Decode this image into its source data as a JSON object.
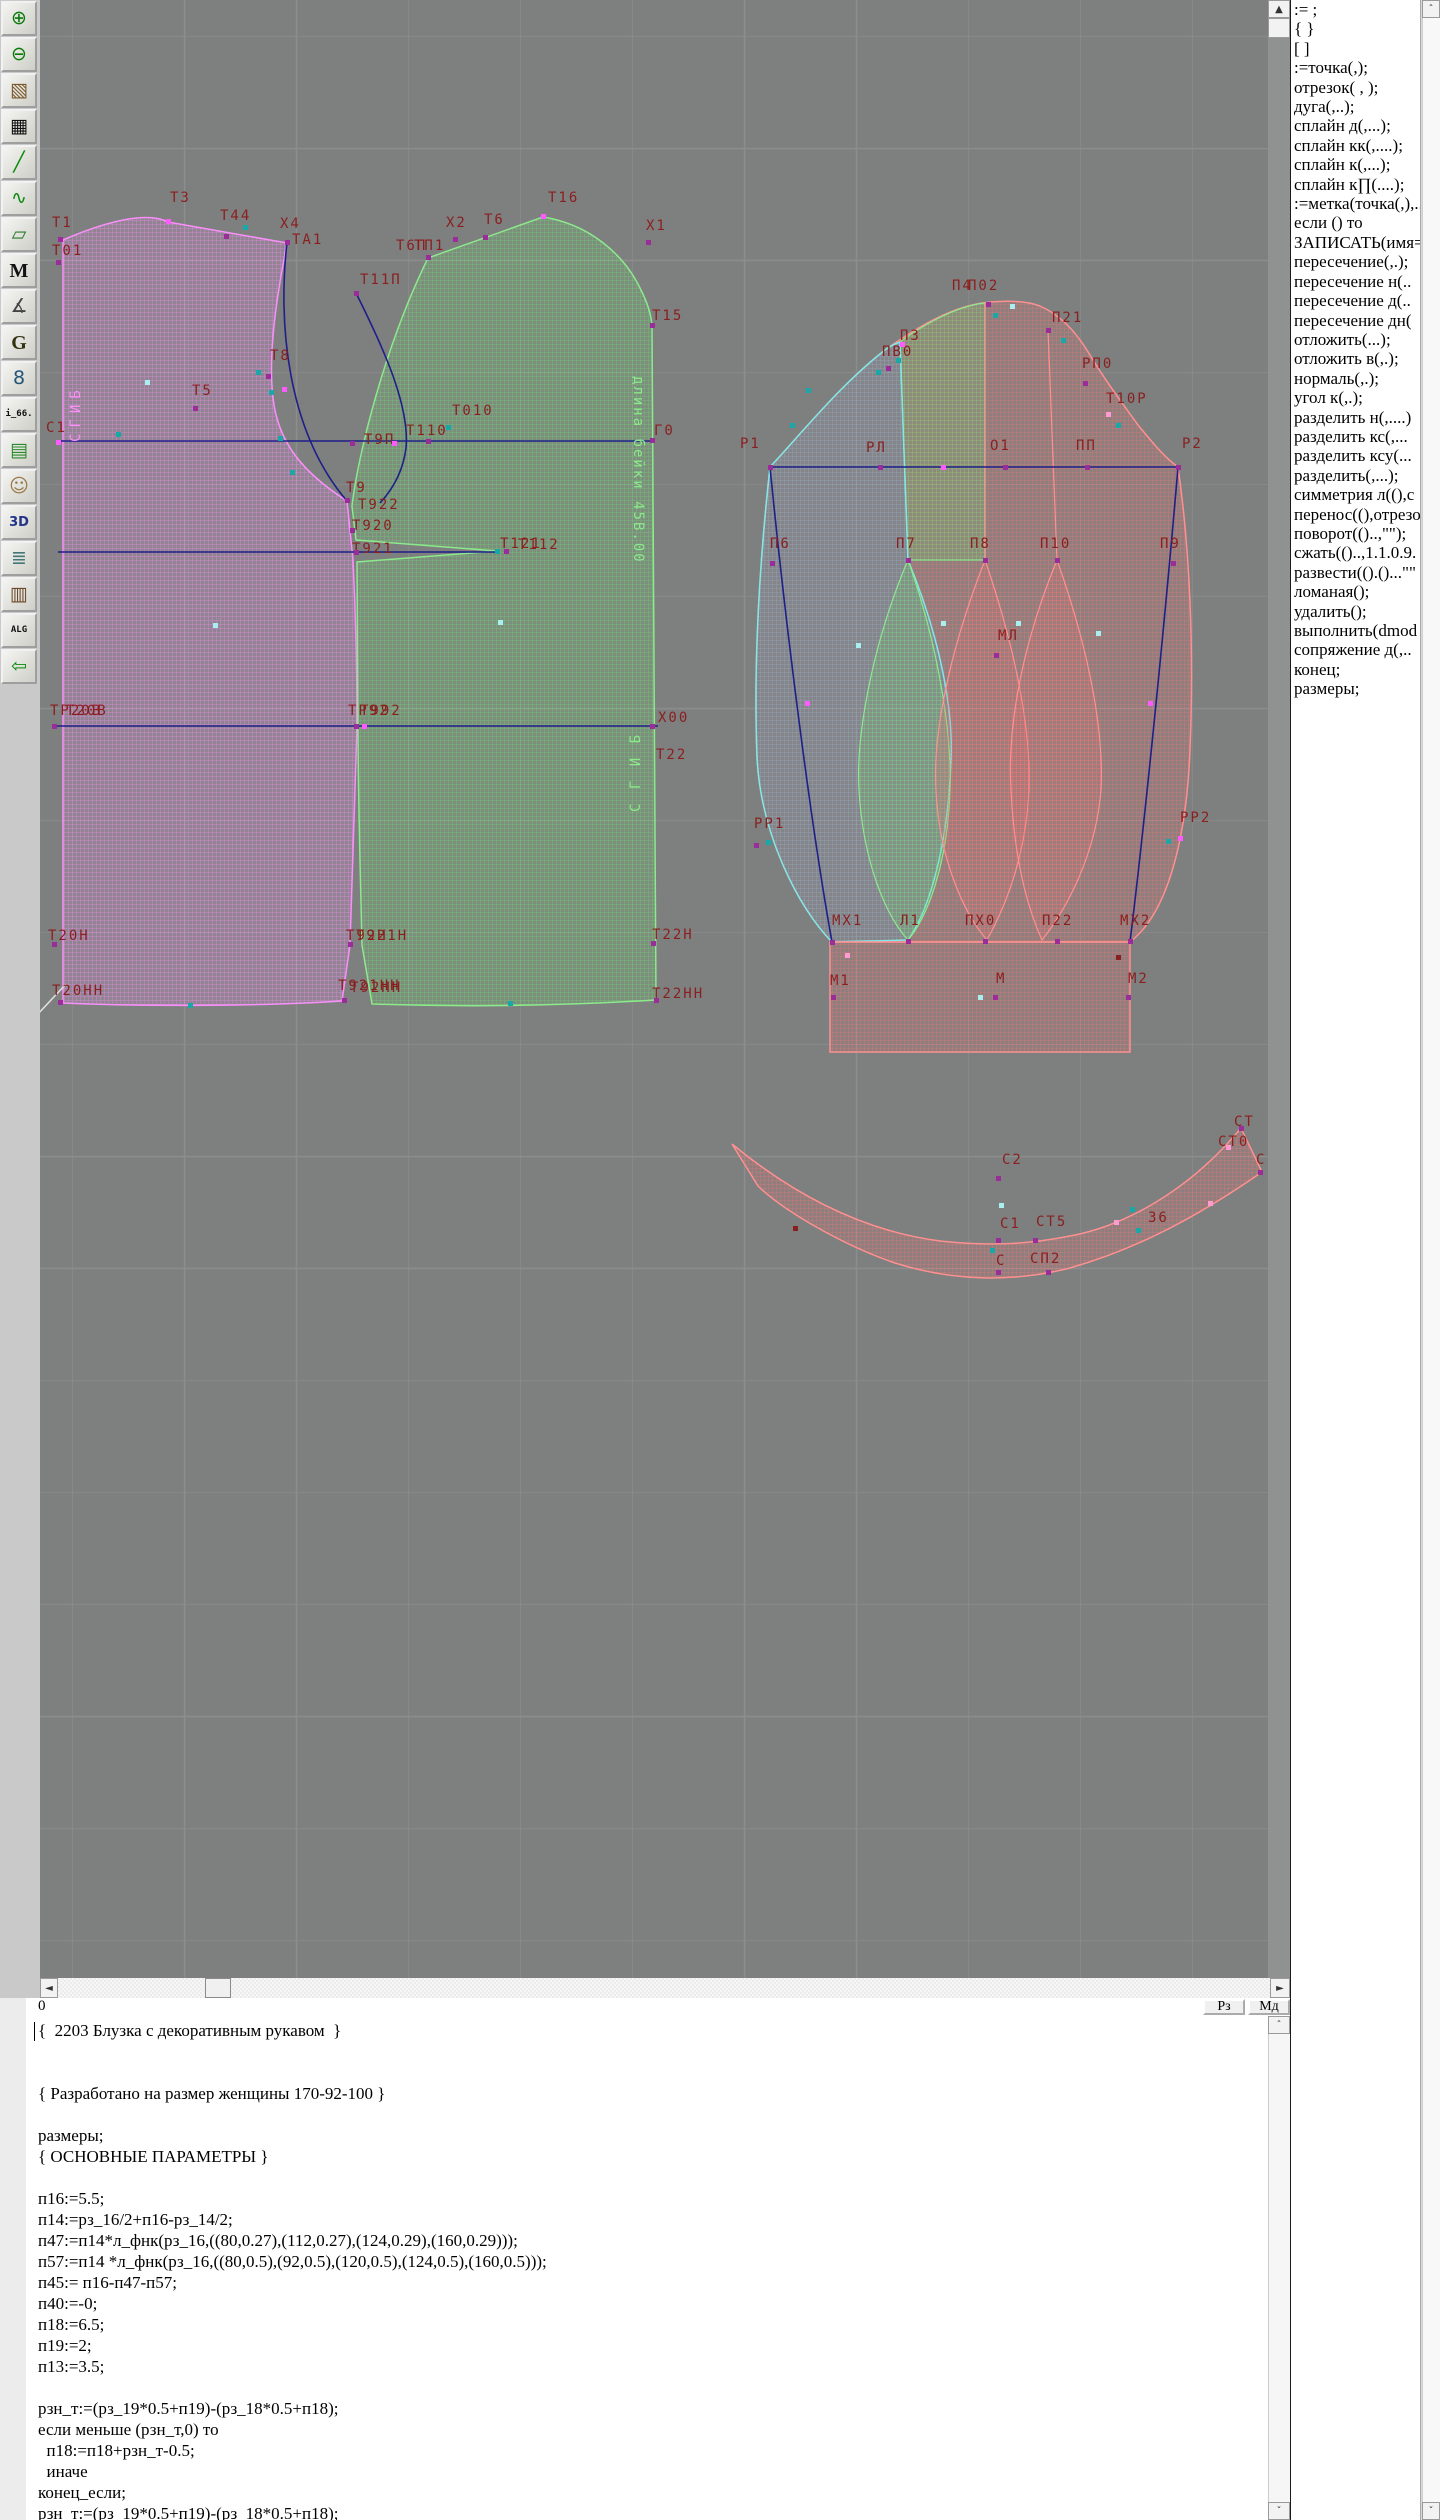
{
  "window": {
    "title": "Pattern design CAD (Грация) – blouse 2203"
  },
  "toolbar": {
    "items": [
      {
        "name": "zoom-in-icon",
        "glyph": "⊕",
        "fg": "#0a7a0a"
      },
      {
        "name": "zoom-out-icon",
        "glyph": "⊖",
        "fg": "#0a7a0a"
      },
      {
        "name": "pattern-preview-icon",
        "glyph": "▧",
        "fg": "#7a5a2a"
      },
      {
        "name": "grid-icon",
        "glyph": "▦",
        "fg": "#111111"
      },
      {
        "name": "segment-icon",
        "glyph": "╱",
        "fg": "#0a8a0a"
      },
      {
        "name": "curve-sheet-icon",
        "glyph": "∿",
        "fg": "#0a8a0a"
      },
      {
        "name": "piece-outline-icon",
        "glyph": "▱",
        "fg": "#2a7a2a"
      },
      {
        "name": "m-text-icon",
        "glyph": "M",
        "fg": "#111111"
      },
      {
        "name": "drafting-tools-icon",
        "glyph": "∡",
        "fg": "#444444"
      },
      {
        "name": "g-text-icon",
        "glyph": "G",
        "fg": "#333311"
      },
      {
        "name": "ruler-icon",
        "glyph": "8",
        "fg": "#225577"
      },
      {
        "name": "i66-icon",
        "glyph": "i_66.",
        "fg": "#111111"
      },
      {
        "name": "table-icon",
        "glyph": "▤",
        "fg": "#2a8a2a"
      },
      {
        "name": "photo-icon",
        "glyph": "☺",
        "fg": "#9a7a4a"
      },
      {
        "name": "threed-icon",
        "glyph": "3D",
        "fg": "#223388"
      },
      {
        "name": "list-icon",
        "glyph": "≣",
        "fg": "#447777"
      },
      {
        "name": "books-icon",
        "glyph": "▥",
        "fg": "#6a4a2a"
      },
      {
        "name": "alg-icon",
        "glyph": "ALG",
        "fg": "#111111"
      },
      {
        "name": "exit-icon",
        "glyph": "⇦",
        "fg": "#0a8a0a"
      }
    ]
  },
  "command_panel": {
    "items": [
      ":=  ;",
      "{  }",
      "[  ]",
      ":=точка(,);",
      "отрезок( , );",
      "дуга(,..);",
      "сплайн  д(,...);",
      "сплайн  кк(,....);",
      "сплайн  к(,...);",
      "сплайн  к∏(....);",
      ":=метка(точка(,),..",
      "если () то",
      "ЗАПИСАТЬ(имя=",
      "пересечение(,.);",
      "пересечение  н(..",
      "пересечение  д(..",
      "пересечение  дн(",
      "отложить(...);",
      "отложить  в(,.);",
      "нормаль(,.);",
      "угол  к(,.);",
      "разделить  н(,....)",
      "разделить  кс(,...",
      "разделить  ксу(...",
      "разделить(,...);",
      "симметрия  л((),с",
      "перенос((),отрезо",
      "поворот(()..,\"\");",
      "сжать(()..,1.1.0.9.",
      "развести(().()...\"\"",
      "ломаная();",
      "удалить();",
      "выполнить(dmod",
      "сопряжение  д(,..",
      "конец;",
      "размеры;"
    ]
  },
  "status": {
    "left": "0",
    "buttons": [
      "Рз",
      "Мд"
    ]
  },
  "code_editor": {
    "lines": [
      "{  2203 Блузка с декоративным рукавом  }",
      "",
      "",
      "{ Разработано на размер женщины 170-92-100 }",
      "",
      "размеры;",
      "{ ОСНОВНЫЕ ПАРАМЕТРЫ }",
      "",
      "п16:=5.5;",
      "п14:=рз_16/2+п16-рз_14/2;",
      "п47:=п14*л_фнк(рз_16,((80,0.27),(112,0.27),(124,0.29),(160,0.29)));",
      "п57:=п14 *л_фнк(рз_16,((80,0.5),(92,0.5),(120,0.5),(124,0.5),(160,0.5)));",
      "п45:= п16-п47-п57;",
      "п40:=-0;",
      "п18:=6.5;",
      "п19:=2;",
      "п13:=3.5;",
      "",
      "рзн_т:=(рз_19*0.5+п19)-(рз_18*0.5+п18);",
      "если меньше (рзн_т,0) то",
      "  п18:=п18+рзн_т-0.5;",
      "  иначе",
      "конец_если;",
      "рзн_т:=(рз_19*0.5+п19)-(рз_18*0.5+п18);"
    ]
  },
  "canvas": {
    "colors": {
      "background": "#7e7f7f",
      "grid": "#8c8d8d",
      "label": "#8a1f1f",
      "navy": "#1f1f8a",
      "pink_outline": "#f990f9",
      "green_outline": "#8ce98c",
      "cyan_outline": "#7fe8e8",
      "red_outline": "#ff9090"
    },
    "labels": [
      [
        "Т1",
        12,
        215
      ],
      [
        "Т01",
        12,
        243
      ],
      [
        "Т3",
        130,
        190
      ],
      [
        "Т44",
        180,
        208
      ],
      [
        "Х4",
        240,
        216
      ],
      [
        "ТА1",
        252,
        232
      ],
      [
        "Т11П",
        320,
        272
      ],
      [
        "Т8",
        230,
        348
      ],
      [
        "Т5",
        152,
        383
      ],
      [
        "С1",
        6,
        420
      ],
      [
        "Т010",
        412,
        403
      ],
      [
        "Т110",
        366,
        423
      ],
      [
        "Т9П",
        324,
        432
      ],
      [
        "Т9",
        306,
        480
      ],
      [
        "Т922",
        318,
        497
      ],
      [
        "Т920",
        312,
        518
      ],
      [
        "Т921",
        312,
        541
      ],
      [
        "Т121",
        460,
        536
      ],
      [
        "Т112",
        478,
        537
      ],
      [
        "Х2",
        406,
        215
      ],
      [
        "Т6",
        444,
        212
      ],
      [
        "Т6П",
        356,
        238
      ],
      [
        "ТП1",
        374,
        238
      ],
      [
        "Т16",
        508,
        190
      ],
      [
        "Х1",
        606,
        218
      ],
      [
        "Т15",
        612,
        308
      ],
      [
        "Г0",
        614,
        423
      ],
      [
        "Х00",
        618,
        710
      ],
      [
        "Т22",
        616,
        747
      ],
      [
        "ТР20В",
        10,
        703
      ],
      [
        "Т20В",
        26,
        703
      ],
      [
        "ТР92",
        308,
        703
      ],
      [
        "Т992",
        320,
        703
      ],
      [
        "Т20Н",
        8,
        928
      ],
      [
        "Т92Н",
        306,
        928
      ],
      [
        "Т921Н",
        316,
        928
      ],
      [
        "Т22Н",
        612,
        927
      ],
      [
        "Т20НН",
        12,
        983
      ],
      [
        "Т921НН",
        298,
        978
      ],
      [
        "Т92НН",
        310,
        980
      ],
      [
        "Т22НН",
        612,
        986
      ],
      [
        "П4",
        912,
        278
      ],
      [
        "П02",
        928,
        278
      ],
      [
        "П21",
        1012,
        310
      ],
      [
        "РП0",
        1042,
        356
      ],
      [
        "Т10Р",
        1066,
        391
      ],
      [
        "П3",
        860,
        328
      ],
      [
        "ПВ0",
        842,
        344
      ],
      [
        "Р1",
        700,
        436
      ],
      [
        "РЛ",
        826,
        440
      ],
      [
        "О1",
        950,
        438
      ],
      [
        "ПП",
        1036,
        438
      ],
      [
        "Р2",
        1142,
        436
      ],
      [
        "П6",
        730,
        536
      ],
      [
        "П7",
        856,
        536
      ],
      [
        "П8",
        930,
        536
      ],
      [
        "П10",
        1000,
        536
      ],
      [
        "П9",
        1120,
        536
      ],
      [
        "МЛ",
        958,
        628
      ],
      [
        "РР1",
        714,
        816
      ],
      [
        "РР2",
        1140,
        810
      ],
      [
        "МХ1",
        792,
        913
      ],
      [
        "Л1",
        860,
        913
      ],
      [
        "ПХ0",
        925,
        913
      ],
      [
        "П22",
        1002,
        913
      ],
      [
        "МХ2",
        1080,
        913
      ],
      [
        "М1",
        790,
        973
      ],
      [
        "М",
        956,
        971
      ],
      [
        "М2",
        1088,
        971
      ],
      [
        "С2",
        962,
        1152
      ],
      [
        "С1",
        960,
        1216
      ],
      [
        "СТ5",
        996,
        1214
      ],
      [
        "З6",
        1108,
        1210
      ],
      [
        "С",
        956,
        1253
      ],
      [
        "СП2",
        990,
        1251
      ],
      [
        "СТ",
        1194,
        1114
      ],
      [
        "СТ0",
        1178,
        1134
      ],
      [
        "С",
        1216,
        1152
      ]
    ],
    "vlabels": [
      {
        "t": "СГИБ",
        "x": 28,
        "y": 442,
        "rot": -90,
        "color": "#f990f9",
        "ls": 6
      },
      {
        "t": "длина бейки 45В.00",
        "x": 606,
        "y": 376,
        "rot": 90,
        "color": "#8ce98c",
        "ls": 2
      },
      {
        "t": "С Г И Б",
        "x": 588,
        "y": 812,
        "rot": -90,
        "color": "#8ce98c",
        "ls": 3
      }
    ],
    "points": [
      [
        20,
        239,
        "p"
      ],
      [
        18,
        262,
        "p"
      ],
      [
        128,
        221,
        "m"
      ],
      [
        186,
        236,
        "p"
      ],
      [
        247,
        242,
        "p"
      ],
      [
        205,
        227,
        "t"
      ],
      [
        316,
        293,
        "p"
      ],
      [
        228,
        376,
        "p"
      ],
      [
        244,
        389,
        "m"
      ],
      [
        218,
        372,
        "t"
      ],
      [
        231,
        392,
        "t"
      ],
      [
        240,
        438,
        "t"
      ],
      [
        252,
        472,
        "t"
      ],
      [
        155,
        408,
        "p"
      ],
      [
        18,
        442,
        "m"
      ],
      [
        78,
        434,
        "t"
      ],
      [
        107,
        382,
        "c"
      ],
      [
        175,
        625,
        "c"
      ],
      [
        460,
        622,
        "c"
      ],
      [
        415,
        239,
        "p"
      ],
      [
        445,
        237,
        "p"
      ],
      [
        388,
        257,
        "p"
      ],
      [
        503,
        216,
        "m"
      ],
      [
        608,
        242,
        "p"
      ],
      [
        612,
        325,
        "p"
      ],
      [
        612,
        440,
        "p"
      ],
      [
        408,
        427,
        "t"
      ],
      [
        388,
        441,
        "p"
      ],
      [
        312,
        443,
        "p"
      ],
      [
        354,
        443,
        "m"
      ],
      [
        307,
        500,
        "p"
      ],
      [
        312,
        530,
        "p"
      ],
      [
        316,
        552,
        "p"
      ],
      [
        457,
        551,
        "t"
      ],
      [
        466,
        551,
        "p"
      ],
      [
        14,
        726,
        "p"
      ],
      [
        316,
        726,
        "p"
      ],
      [
        324,
        726,
        "m"
      ],
      [
        612,
        726,
        "p"
      ],
      [
        14,
        944,
        "p"
      ],
      [
        310,
        944,
        "p"
      ],
      [
        613,
        943,
        "p"
      ],
      [
        20,
        1002,
        "p"
      ],
      [
        304,
        1000,
        "p"
      ],
      [
        616,
        1000,
        "p"
      ],
      [
        150,
        1005,
        "t"
      ],
      [
        470,
        1003,
        "t"
      ],
      [
        730,
        467,
        "p"
      ],
      [
        840,
        467,
        "p"
      ],
      [
        903,
        467,
        "m"
      ],
      [
        965,
        467,
        "p"
      ],
      [
        1047,
        467,
        "p"
      ],
      [
        1138,
        467,
        "p"
      ],
      [
        948,
        304,
        "p"
      ],
      [
        955,
        315,
        "t"
      ],
      [
        972,
        306,
        "c"
      ],
      [
        1008,
        330,
        "p"
      ],
      [
        1023,
        340,
        "t"
      ],
      [
        1045,
        383,
        "p"
      ],
      [
        1068,
        414,
        "k"
      ],
      [
        1078,
        425,
        "t"
      ],
      [
        862,
        344,
        "m"
      ],
      [
        848,
        368,
        "p"
      ],
      [
        838,
        372,
        "t"
      ],
      [
        858,
        360,
        "t"
      ],
      [
        768,
        390,
        "t"
      ],
      [
        752,
        425,
        "t"
      ],
      [
        732,
        563,
        "p"
      ],
      [
        868,
        560,
        "p"
      ],
      [
        945,
        560,
        "p"
      ],
      [
        1017,
        560,
        "p"
      ],
      [
        1133,
        563,
        "p"
      ],
      [
        956,
        655,
        "p"
      ],
      [
        818,
        645,
        "c"
      ],
      [
        903,
        623,
        "c"
      ],
      [
        978,
        623,
        "c"
      ],
      [
        1058,
        633,
        "c"
      ],
      [
        767,
        703,
        "m"
      ],
      [
        1110,
        703,
        "m"
      ],
      [
        716,
        845,
        "p"
      ],
      [
        728,
        842,
        "t"
      ],
      [
        1140,
        838,
        "m"
      ],
      [
        1128,
        841,
        "t"
      ],
      [
        792,
        942,
        "p"
      ],
      [
        868,
        941,
        "p"
      ],
      [
        945,
        941,
        "p"
      ],
      [
        1017,
        941,
        "p"
      ],
      [
        1090,
        941,
        "p"
      ],
      [
        793,
        997,
        "p"
      ],
      [
        955,
        997,
        "p"
      ],
      [
        940,
        997,
        "c"
      ],
      [
        1088,
        997,
        "p"
      ],
      [
        807,
        955,
        "k"
      ],
      [
        1078,
        957,
        "r"
      ],
      [
        958,
        1178,
        "p"
      ],
      [
        961,
        1205,
        "c"
      ],
      [
        958,
        1240,
        "p"
      ],
      [
        995,
        1240,
        "p"
      ],
      [
        1098,
        1230,
        "t"
      ],
      [
        958,
        1272,
        "p"
      ],
      [
        1008,
        1272,
        "p"
      ],
      [
        952,
        1250,
        "t"
      ],
      [
        1076,
        1222,
        "k"
      ],
      [
        1092,
        1209,
        "t"
      ],
      [
        1170,
        1203,
        "k"
      ],
      [
        1201,
        1128,
        "p"
      ],
      [
        1188,
        1147,
        "k"
      ],
      [
        1220,
        1172,
        "p"
      ],
      [
        755,
        1228,
        "r"
      ]
    ],
    "point_colors": {
      "p": "#9b2d9b",
      "m": "#ff5aff",
      "t": "#18a8a8",
      "c": "#a8f0f0",
      "k": "#ff9ad2",
      "r": "#8a1f1f",
      "w": "#ffffff"
    }
  },
  "scroll_glyphs": {
    "up": "▲",
    "down": "▼",
    "left": "◄",
    "right": "►",
    "thin_up": "ˆ",
    "thin_down": "ˇ"
  }
}
